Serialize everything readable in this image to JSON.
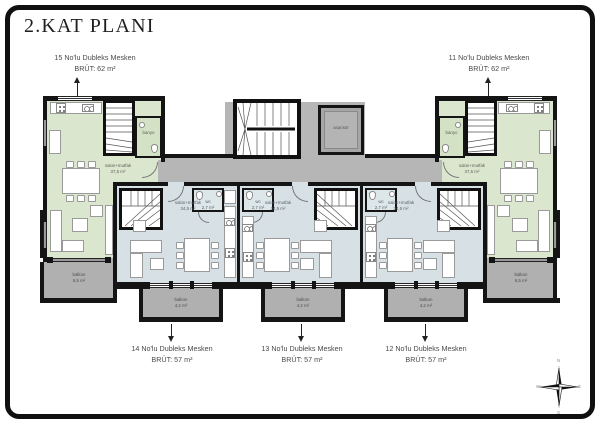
{
  "title": "2.KAT PLANI",
  "callouts": {
    "u15": {
      "name": "15 No'lu Dubleks Mesken",
      "area": "BRÜT: 62 m²"
    },
    "u11": {
      "name": "11 No'lu Dubleks Mesken",
      "area": "BRÜT: 62 m²"
    },
    "u14": {
      "name": "14 No'lu Dubleks Mesken",
      "area": "BRÜT: 57 m²"
    },
    "u13": {
      "name": "13 No'lu Dubleks Mesken",
      "area": "BRÜT: 57 m²"
    },
    "u12": {
      "name": "12 No'lu Dubleks Mesken",
      "area": "BRÜT: 57 m²"
    }
  },
  "rooms": {
    "salon_label": "salon+mutfak",
    "salon_area_green": "37,5 m²",
    "salon_area_blue": "34,5 m²",
    "wc_label": "wc",
    "wc_area": "2,7 m²",
    "bath_label": "banyo",
    "elevator_label": "asansör",
    "balcony_label": "balkon",
    "balcony_area_side": "6,5 m²",
    "balcony_area_bottom": "4,2 m²"
  },
  "compass": {
    "north": "N",
    "east": "E",
    "south": "S",
    "west": "W"
  },
  "colors": {
    "wall": "#141414",
    "room_green": "#dbe6cf",
    "room_blue": "#d7e1e5",
    "circulation_gray": "#b6b6b6",
    "balcony_gray": "#b0b0b0"
  }
}
